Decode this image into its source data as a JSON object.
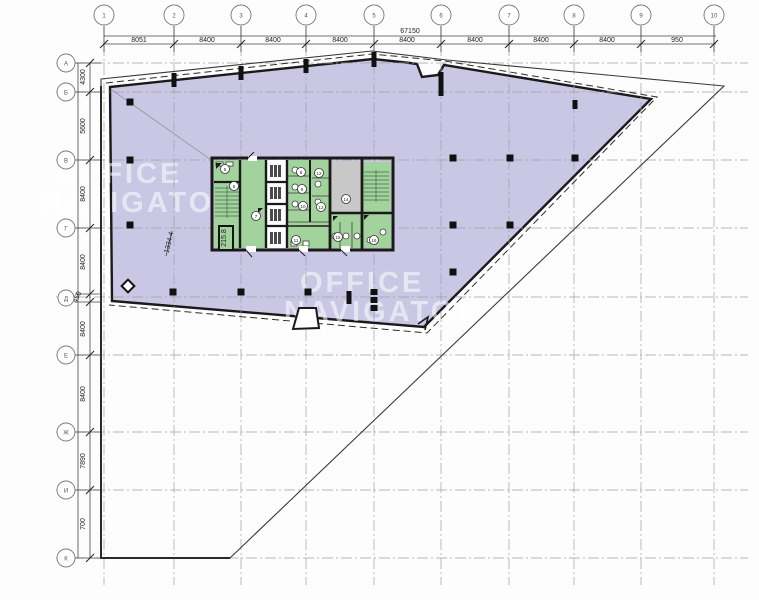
{
  "watermark": {
    "line1": "OFFICE",
    "line2": "NAVIGATOR"
  },
  "axes": {
    "top_labels": [
      "1",
      "2",
      "3",
      "4",
      "5",
      "6",
      "7",
      "8",
      "9",
      "10"
    ],
    "left_labels": [
      "А",
      "Б",
      "В",
      "Г",
      "Д",
      "Е",
      "Ж",
      "И",
      "К"
    ],
    "top_dims": [
      "8051",
      "8400",
      "8400",
      "8400",
      "8400",
      "8400",
      "8400",
      "8400",
      "950"
    ],
    "top_total": "67150",
    "left_dims": [
      "4300",
      "5600",
      "8400",
      "8400",
      "450",
      "8400",
      "8400",
      "7890",
      "700"
    ]
  },
  "areas": {
    "hall": "1334.4",
    "stair": "215.8"
  },
  "rooms": {
    "numbers": [
      "5",
      "6",
      "7",
      "8",
      "9",
      "10",
      "11",
      "12",
      "13",
      "14",
      "15",
      "16"
    ]
  },
  "colors": {
    "floor_fill": "#c9c7e4",
    "room_green": "#a3d39d",
    "room_gray": "#c8c8c8",
    "wall": "#1a1a1a"
  }
}
